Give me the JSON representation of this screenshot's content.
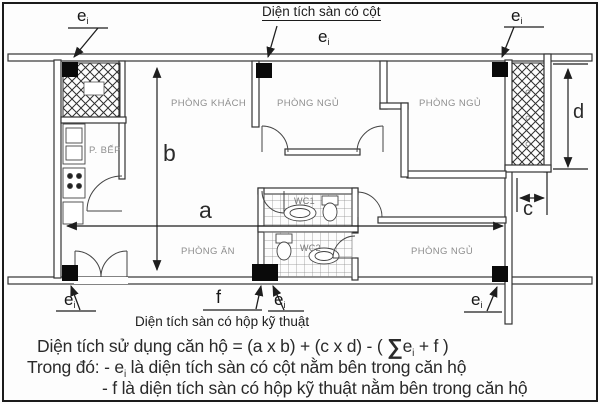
{
  "annotations": {
    "top_note": "Diện tích sàn có cột",
    "bottom_note": "Diện tích sàn có hộp kỹ thuật",
    "e_label": "e",
    "e_sub": "i",
    "f_label": "f"
  },
  "rooms": {
    "living": "PHÒNG KHÁCH",
    "bedroom_mid": "PHÒNG NGỦ",
    "bedroom_topright": "PHÒNG NGỦ",
    "bedroom_botright": "PHÒNG NGỦ",
    "kitchen": "P. BẾP",
    "dining": "PHÒNG ĂN",
    "wc1": "WC1",
    "wc2": "WC2"
  },
  "dimensions": {
    "a": "a",
    "b": "b",
    "c": "c",
    "d": "d"
  },
  "formula": {
    "l1_pre": "Diện tích sử dụng căn hộ = (a x b) + (c x d) - ( ",
    "sigma": "∑",
    "e": "e",
    "e_sub": "i",
    "l1_post": " + f )",
    "l2_pre": "Trong đó: - e",
    "l2_post": " là diện tích sàn có cột nằm bên trong căn hộ",
    "l3": "- f là diện tích sàn có hộp kỹ thuật nằm bên trong căn hộ"
  },
  "colors": {
    "line": "#333333",
    "column": "#0a0a0a",
    "text": "#1e1e1e",
    "room_label": "#8e8e8e"
  }
}
